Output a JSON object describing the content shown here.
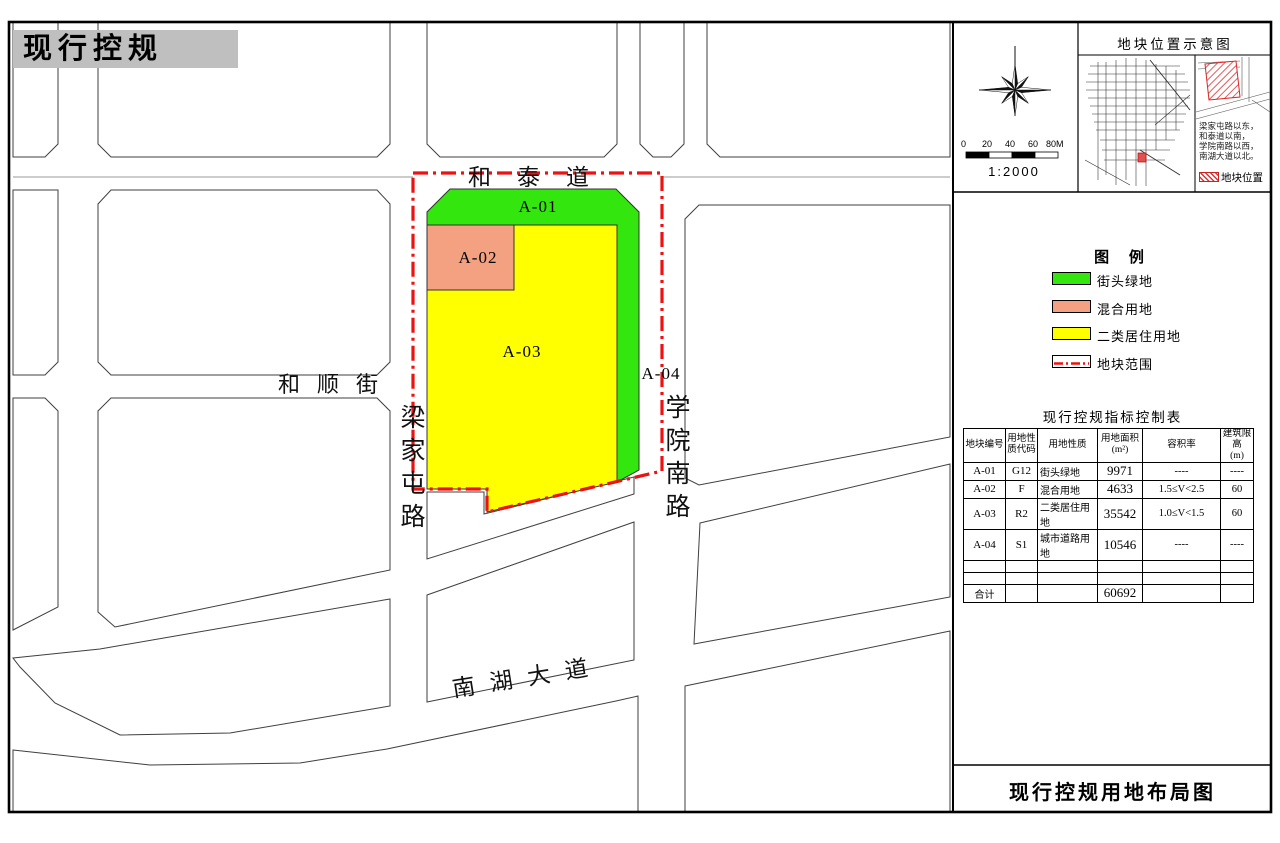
{
  "header": {
    "title": "现行控规"
  },
  "map": {
    "road_labels": {
      "hetai": "和泰道",
      "heshun": "和顺街",
      "liangjiatun": "梁家屯路",
      "xueyuan": "学院南路",
      "nanhu": "南湖大道"
    },
    "parcel_labels": {
      "a01": "A-01",
      "a02": "A-02",
      "a03": "A-03",
      "a04": "A-04"
    },
    "colors": {
      "green": "#33E60D",
      "salmon": "#F4A182",
      "yellow": "#FFFF00",
      "boundary_red": "#EE1111"
    }
  },
  "panel": {
    "north_box": {
      "scale_ticks": [
        "0",
        "20",
        "40",
        "60",
        "80M"
      ],
      "scale_ratio": "1:2000"
    },
    "location": {
      "title": "地块位置示意图",
      "desc": [
        "梁家屯路以东，",
        "和泰道以南，",
        "学院南路以西，",
        "南湖大道以北。"
      ],
      "marker_label": "地块位置"
    },
    "legend": {
      "title": "图 例",
      "items": [
        {
          "label": "街头绿地",
          "color": "#33E60D"
        },
        {
          "label": "混合用地",
          "color": "#F4A182"
        },
        {
          "label": "二类居住用地",
          "color": "#FFFF00"
        },
        {
          "label": "地块范围",
          "color": "#EE1111"
        }
      ]
    },
    "table": {
      "title": "现行控规指标控制表",
      "headers": [
        [
          "地块编号",
          ""
        ],
        [
          "用地性",
          "质代码"
        ],
        [
          "用地性质",
          ""
        ],
        [
          "用地面积",
          "(m²)"
        ],
        [
          "容积率",
          ""
        ],
        [
          "建筑限高",
          "(m)"
        ]
      ],
      "rows": [
        [
          "A-01",
          "G12",
          "街头绿地",
          "9971",
          "----",
          "----"
        ],
        [
          "A-02",
          "F",
          "混合用地",
          "4633",
          "1.5≤V<2.5",
          "60"
        ],
        [
          "A-03",
          "R2",
          "二类居住用地",
          "35542",
          "1.0≤V<1.5",
          "60"
        ],
        [
          "A-04",
          "S1",
          "城市道路用地",
          "10546",
          "----",
          "----"
        ]
      ],
      "total": {
        "label": "合计",
        "area": "60692"
      }
    },
    "footer": {
      "title": "现行控规用地布局图"
    }
  }
}
